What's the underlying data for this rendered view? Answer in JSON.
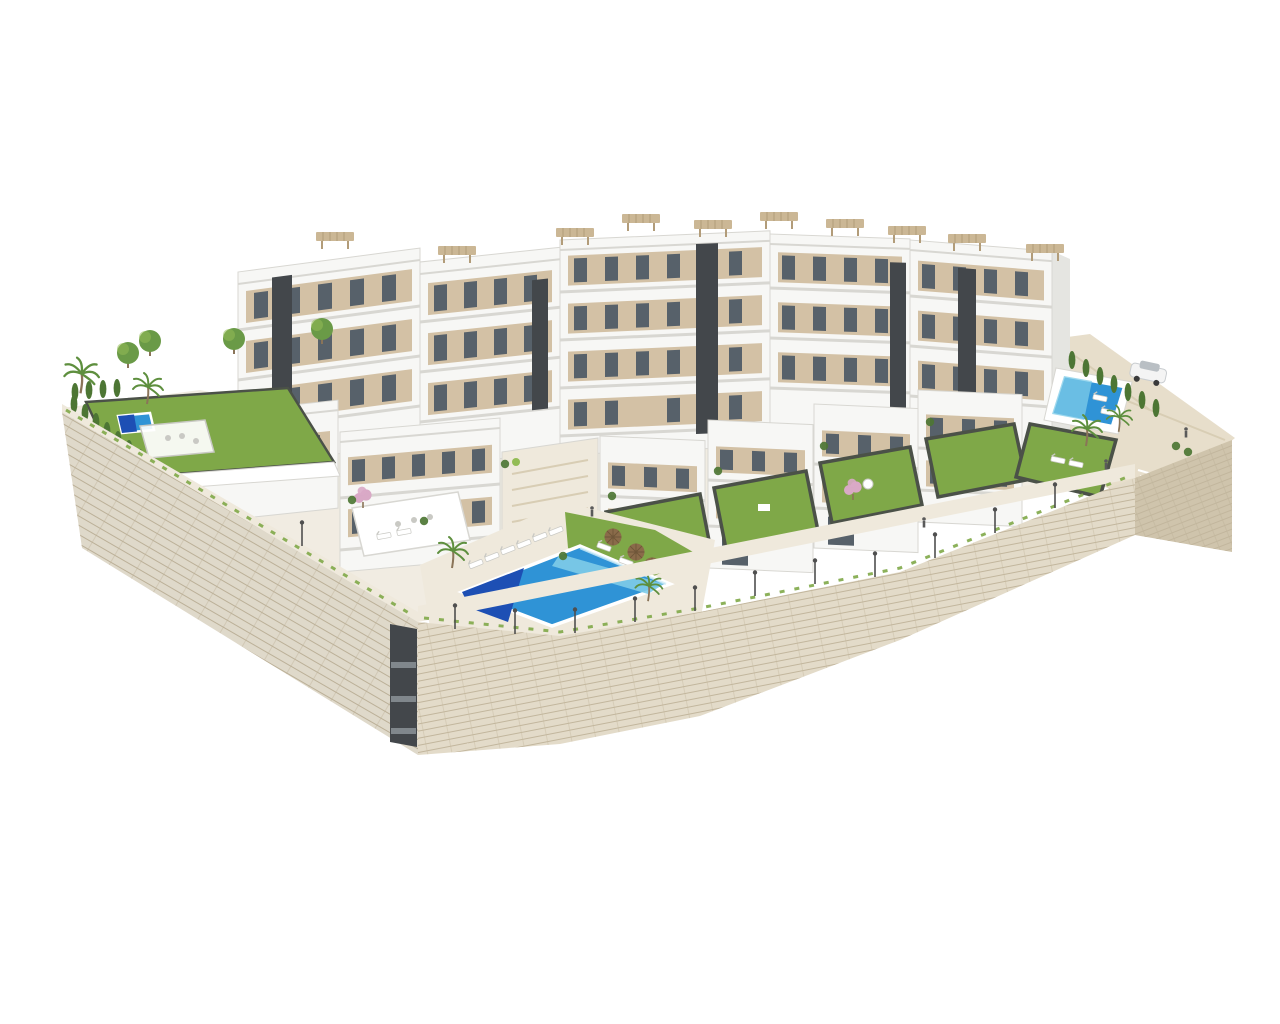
{
  "scene": {
    "title": "Aerial 3D render of a new-build hillside residential complex",
    "description": "Architectural visualization, aerial isometric view on a white background: stepped modern white apartment buildings and townhouses with beige window bays, dark anthracite stair cores and slatted rooftop pergolas; private lawned gardens with dark edging; a large communal infinity pool with sun loungers and brown parasols; a small private pool in the west garden behind a cypress hedge with a palm tree; an east communal pool with sun deck, hedge and a parked white car on a sandy slope; promenade paths with street lamps and a few people; everything enclosed by tall beige stone retaining walls meeting at a corner with a dark stair shaft.",
    "background": "#ffffff",
    "view": "aerial isometric",
    "lighting": "bright daylight"
  },
  "colors": {
    "background": "#ffffff",
    "ground_light": "#f1ece2",
    "terrain_sand": "#e7decb",
    "sand_shade": "#d8cdb4",
    "wall_stone": "#e7e0d1",
    "wall_stone_front": "#e3dbc9",
    "wall_stone_dark": "#cfc4ac",
    "wall_texture_line": "#c2b69d",
    "path_light": "#efe9dc",
    "building_front": "#f7f7f5",
    "building_side": "#e5e5e1",
    "building_white": "#ffffff",
    "slab_line": "#d8d7d2",
    "accent_tan": "#d3c1a5",
    "accent_tan_dark": "#bfa987",
    "core_dark": "#43474b",
    "core_band": "#80878c",
    "window_dark": "#57616a",
    "window_glass": "#bcc6cb",
    "railing_gray": "#abb1b3",
    "pergola_beige": "#cbb795",
    "pergola_slat": "#b29c79",
    "grass_green": "#7fa848",
    "grass_light": "#93bc55",
    "lawn_edge": "#4b5148",
    "hedge_dark": "#4d7634",
    "palm_green": "#5e8f3e",
    "tree_green": "#6a9a47",
    "pink_blossom": "#d9a9c6",
    "trunk_brown": "#8a7458",
    "pool_deep": "#1d4fb4",
    "pool_mid": "#2f93d6",
    "pool_light": "#7fcce8",
    "pool_foam": "#cfeef7",
    "pool_rim": "#ffffff",
    "umbrella_brown": "#8a6b4a",
    "umbrella_dark": "#6f5639",
    "lamp_post": "#4f4f4f",
    "car_body": "#f4f4f4",
    "car_trim": "#c9cdd0",
    "car_glass": "#b9bfc4",
    "wheel_dark": "#3a3a3a",
    "figure_dark": "#5a5a5a",
    "furniture_white": "#ffffff",
    "furniture_stroke": "#c9c9c4"
  },
  "inventory": {
    "apartment_blocks": 5,
    "villas_and_townhouses": 6,
    "swimming_pools": 3,
    "rooftop_pergolas": 10,
    "private_lawns": 6,
    "palm_trees": 6,
    "cypress_hedge_rows": 2,
    "street_lamps": 12,
    "sun_loungers": 13,
    "pool_umbrellas": 3,
    "parked_cars": 1,
    "people": 4,
    "ornamental_trees": 4,
    "flowering_trees": 2,
    "retaining_wall_sections": 3
  }
}
